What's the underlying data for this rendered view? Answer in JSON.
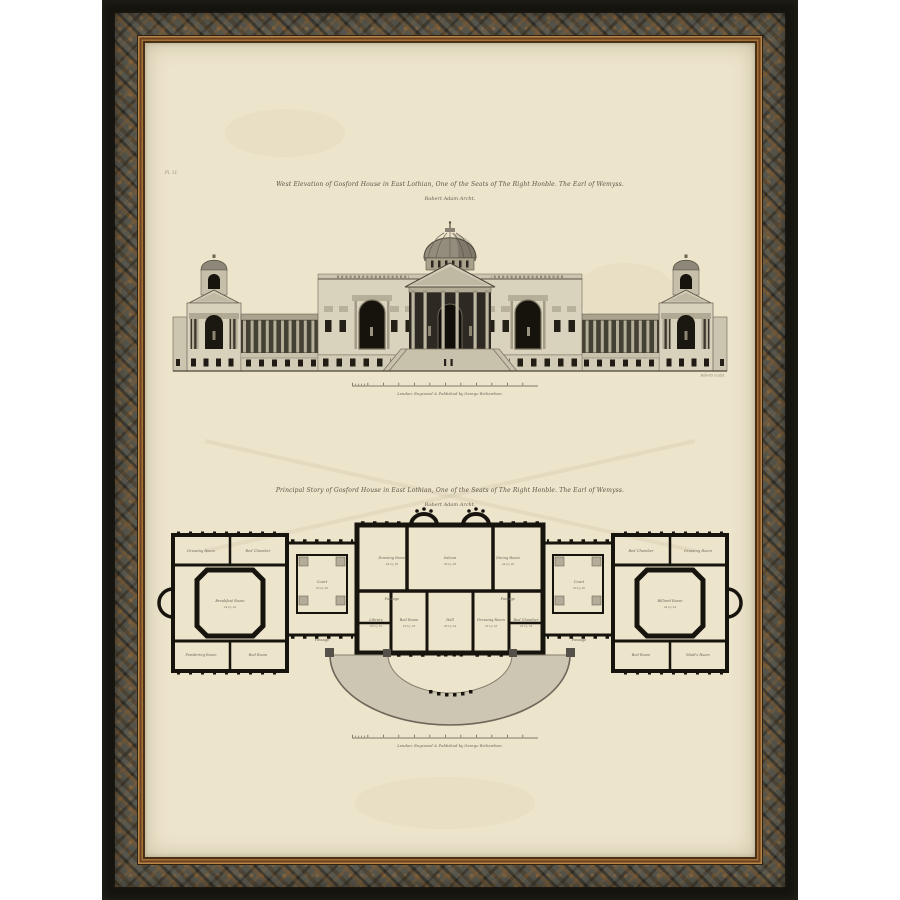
{
  "artwork": {
    "plate_mark": "Pl. 11.",
    "elevation": {
      "caption_line1": "West Elevation of Gosford House in East Lothian, One of the Seats of The Right Honble. The Earl of Wemyss.",
      "caption_line2": "Robert Adam Archt.",
      "engraver_credit": "Roberts sculpt.",
      "imprint": "London: Engraved & Published by George Richardson."
    },
    "plan": {
      "caption_line1": "Principal Story of Gosford House in East Lothian, One of the Seats of The Right Honble. The Earl of Wemyss.",
      "caption_line2": "Robert Adam Archt.",
      "imprint": "London: Engraved & Published by George Richardson.",
      "rooms": [
        {
          "label": "Drawing Room",
          "dim": "44 by 28",
          "x": 247,
          "y": 516
        },
        {
          "label": "Saloon",
          "dim": "36 by 28",
          "x": 305,
          "y": 516
        },
        {
          "label": "Dining Room",
          "dim": "44 by 28",
          "x": 363,
          "y": 516
        },
        {
          "label": "Passage",
          "x": 247,
          "y": 557
        },
        {
          "label": "Passage",
          "x": 363,
          "y": 557
        },
        {
          "label": "Library",
          "dim": "30 by 22",
          "x": 231,
          "y": 578
        },
        {
          "label": "Bed Room",
          "dim": "22 by 18",
          "x": 264,
          "y": 578
        },
        {
          "label": "Hall",
          "dim": "36 by 24",
          "x": 305,
          "y": 578
        },
        {
          "label": "Dressing Room",
          "dim": "22 by 18",
          "x": 346,
          "y": 578
        },
        {
          "label": "Bed Chamber",
          "dim": "22 by 18",
          "x": 381,
          "y": 578
        },
        {
          "label": "Court",
          "dim": "20 by 20",
          "x": 177,
          "y": 540
        },
        {
          "label": "Court",
          "dim": "20 by 20",
          "x": 434,
          "y": 540
        },
        {
          "label": "Passage",
          "x": 177,
          "y": 598
        },
        {
          "label": "Passage",
          "x": 434,
          "y": 598
        },
        {
          "label": "Dressing Room",
          "x": 56,
          "y": 509
        },
        {
          "label": "Bed Chamber",
          "x": 113,
          "y": 509
        },
        {
          "label": "Breakfast Room",
          "dim": "24 by 24",
          "x": 85,
          "y": 559
        },
        {
          "label": "Powdering Room",
          "x": 56,
          "y": 613
        },
        {
          "label": "Bed Room",
          "x": 113,
          "y": 613
        },
        {
          "label": "Bed Chamber",
          "x": 496,
          "y": 509
        },
        {
          "label": "Dressing Room",
          "x": 553,
          "y": 509
        },
        {
          "label": "Billiard Room",
          "dim": "24 by 24",
          "x": 525,
          "y": 559
        },
        {
          "label": "Bed Room",
          "x": 496,
          "y": 613
        },
        {
          "label": "Maid's Room",
          "x": 553,
          "y": 613
        }
      ]
    },
    "colors": {
      "frame_black": "#15140f",
      "frame_bronze": "#8a5a28",
      "frame_gold": "#b8864a",
      "ornate_base": "#55544a",
      "paper": "#ece4cb",
      "ink": "#2c2820"
    }
  }
}
